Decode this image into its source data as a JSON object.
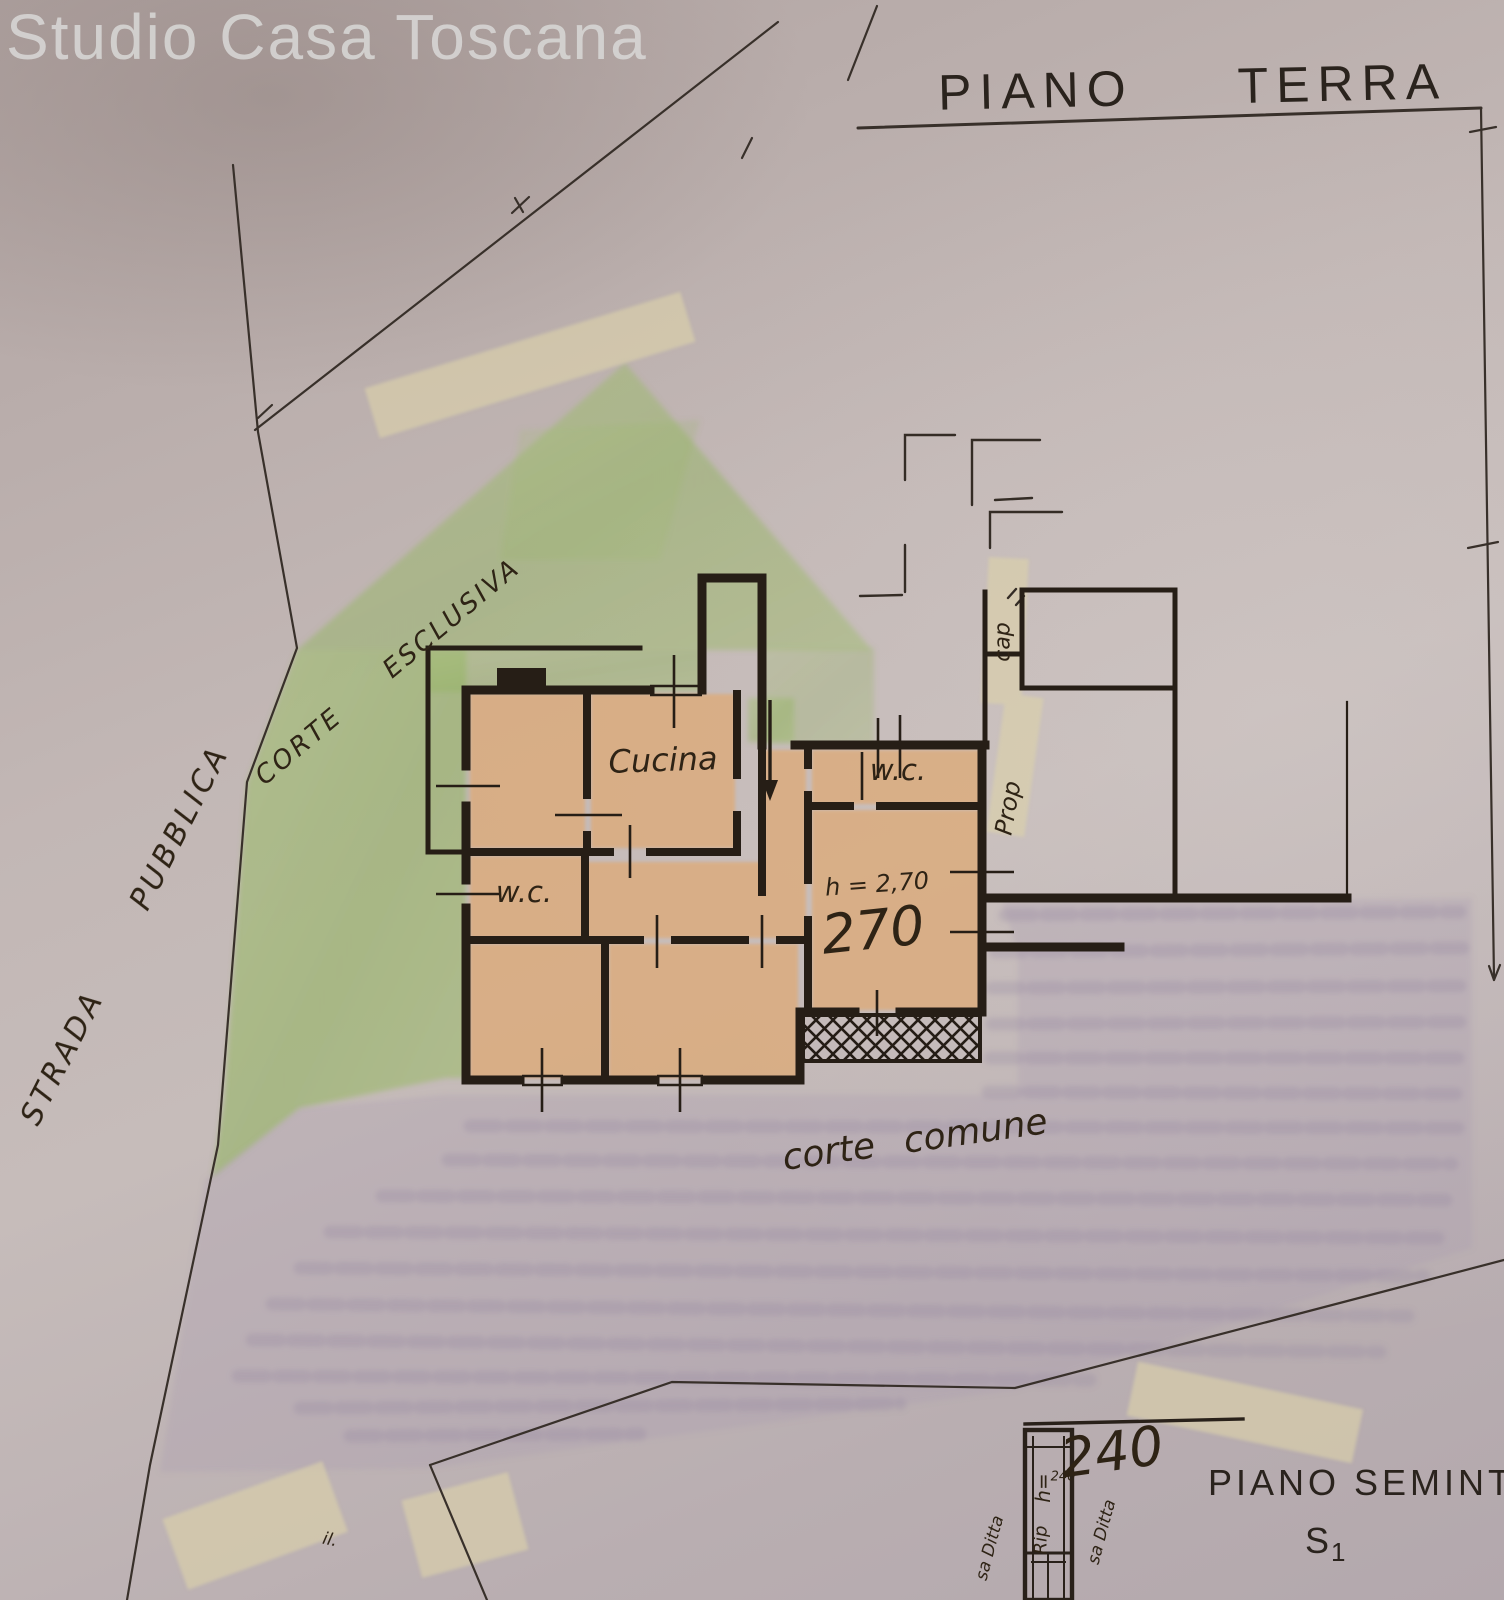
{
  "watermark": "Studio Casa Toscana",
  "titles": {
    "floor_word1": "PIANO",
    "floor_word2": "TERRA",
    "basement_title": "PIANO SEMINTE",
    "basement_code_main": "S",
    "basement_code_sub": "1"
  },
  "site_labels": {
    "public_road": "STRADA  PUBBLICA",
    "exclusive_court": "CORTE  ESCLUSIVA",
    "common_court": "corte comune",
    "cap_note": "cap",
    "prop_note": "Prop",
    "il_note": "il."
  },
  "room_labels": {
    "kitchen": "Cucina",
    "wc_right": "w.c.",
    "wc_left": "w.c.",
    "height_note": "h = 2,70",
    "height_value": "270"
  },
  "basement_labels": {
    "height_value_large": "240",
    "height_prefix": "h=",
    "height_small": "240",
    "storage": "Rip",
    "firm_left": "sa Ditta",
    "firm_right": "sa Ditta"
  },
  "colors": {
    "paper": "#c2b7b5",
    "ink": "#29211a",
    "green_courtyard": "#9cba6e",
    "room_fill": "#dcab7c",
    "common_court_shading": "#a89bb0",
    "correction_tape": "#dbd1aa",
    "watermark_text": "#d8d7d5"
  }
}
